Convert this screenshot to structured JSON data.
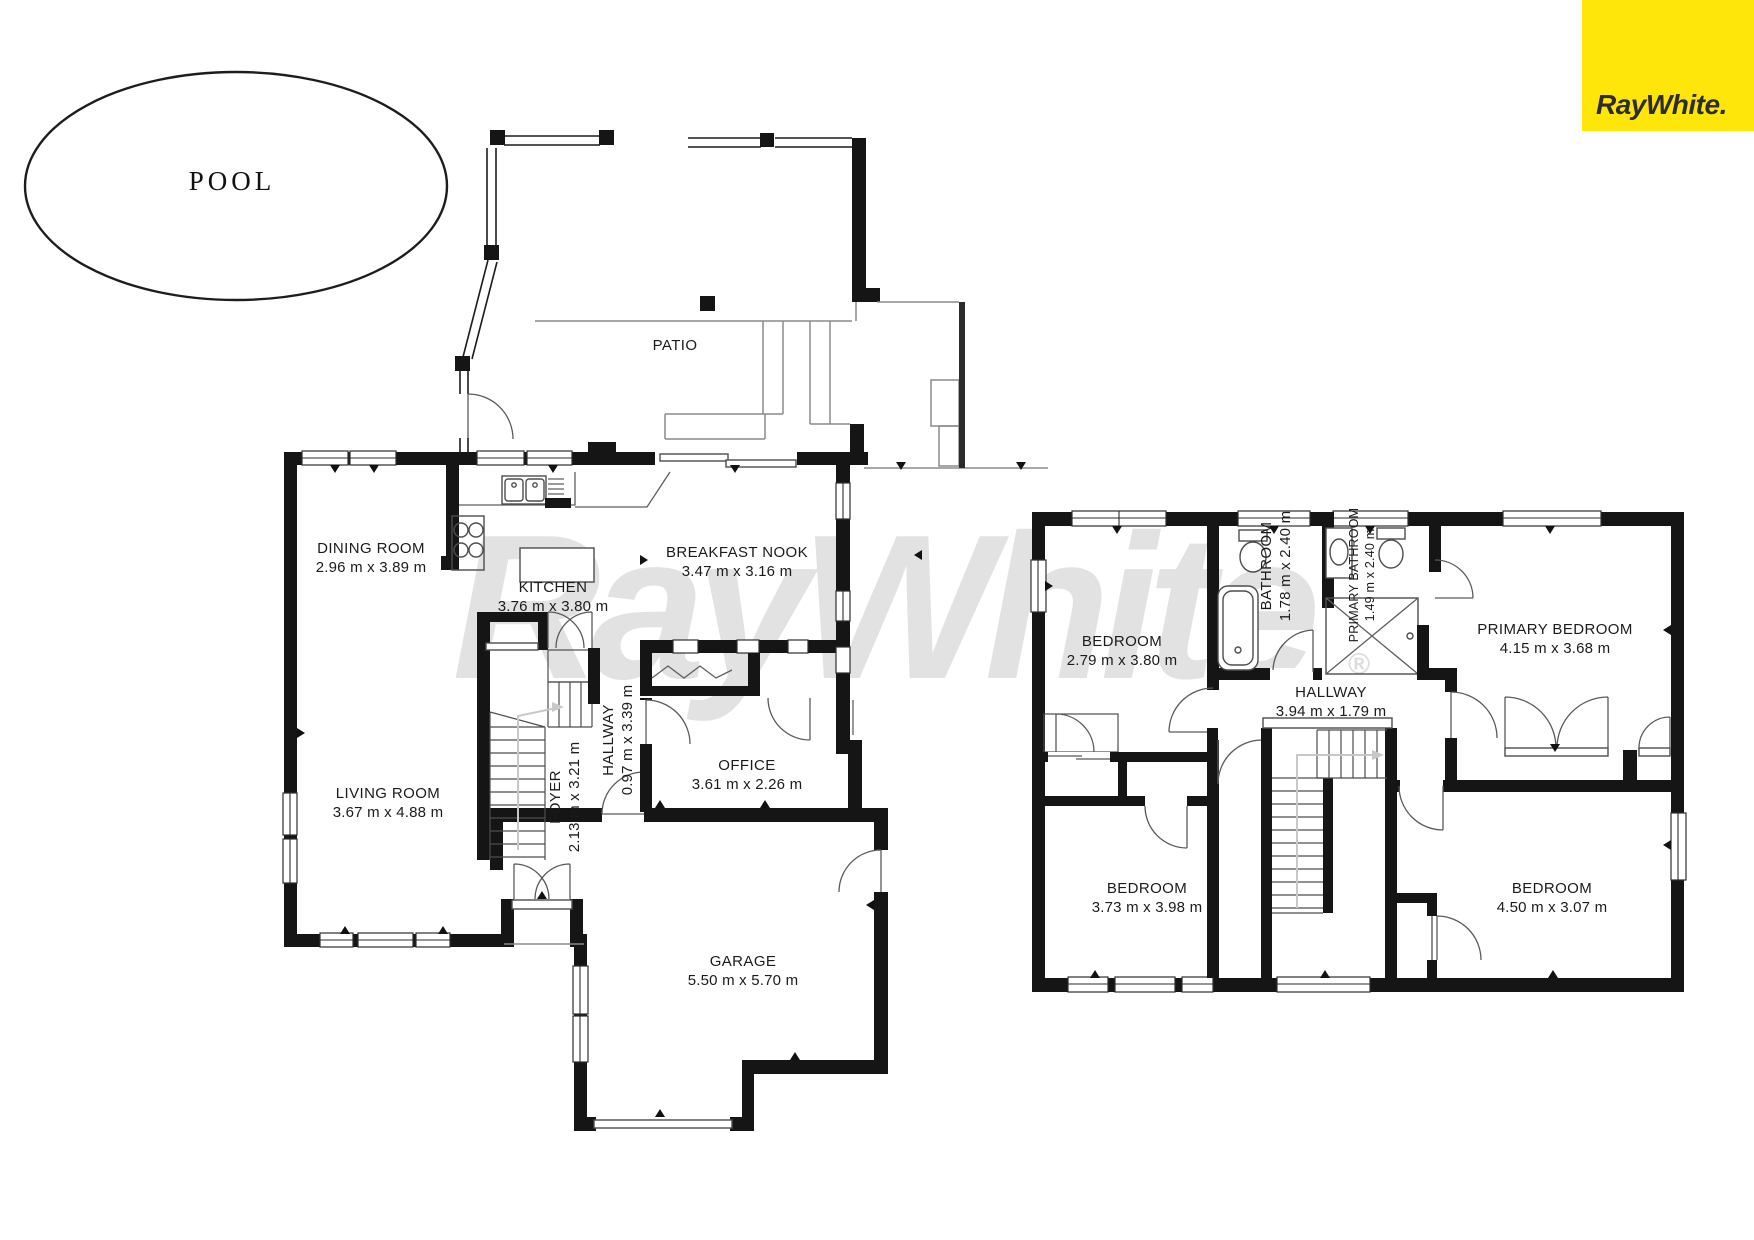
{
  "branding": {
    "logo_text": "RayWhite.",
    "logo_bg": "#FFE60A",
    "logo_fg": "#2D2D2D",
    "watermark_text": "RayWhite",
    "watermark_reg": "®",
    "watermark_color": "#E2E2E2"
  },
  "pool": {
    "label": "POOL"
  },
  "ground_floor": {
    "patio_label": "PATIO",
    "rooms": [
      {
        "name": "DINING ROOM",
        "dims": "2.96 m x 3.89 m"
      },
      {
        "name": "KITCHEN",
        "dims": "3.76 m x 3.80 m"
      },
      {
        "name": "BREAKFAST NOOK",
        "dims": "3.47 m x 3.16 m"
      },
      {
        "name": "LIVING ROOM",
        "dims": "3.67 m x 4.88 m"
      },
      {
        "name": "FOYER",
        "dims": "2.13 m x 3.21 m"
      },
      {
        "name": "HALLWAY",
        "dims": "0.97 m x 3.39 m"
      },
      {
        "name": "OFFICE",
        "dims": "3.61 m x 2.26 m"
      },
      {
        "name": "GARAGE",
        "dims": "5.50 m x 5.70 m"
      }
    ]
  },
  "upper_floor": {
    "rooms": [
      {
        "name": "BEDROOM",
        "dims": "2.79 m x 3.80 m"
      },
      {
        "name": "BATHROOM",
        "dims": "1.78 m x 2.40 m"
      },
      {
        "name": "PRIMARY BATHROOM",
        "dims": "1.49 m x 2.40 m"
      },
      {
        "name": "PRIMARY BEDROOM",
        "dims": "4.15 m x 3.68 m"
      },
      {
        "name": "HALLWAY",
        "dims": "3.94 m x 1.79 m"
      },
      {
        "name": "BEDROOM",
        "dims": "3.73 m x 3.98 m"
      },
      {
        "name": "BEDROOM",
        "dims": "4.50 m x 3.07 m"
      }
    ]
  }
}
